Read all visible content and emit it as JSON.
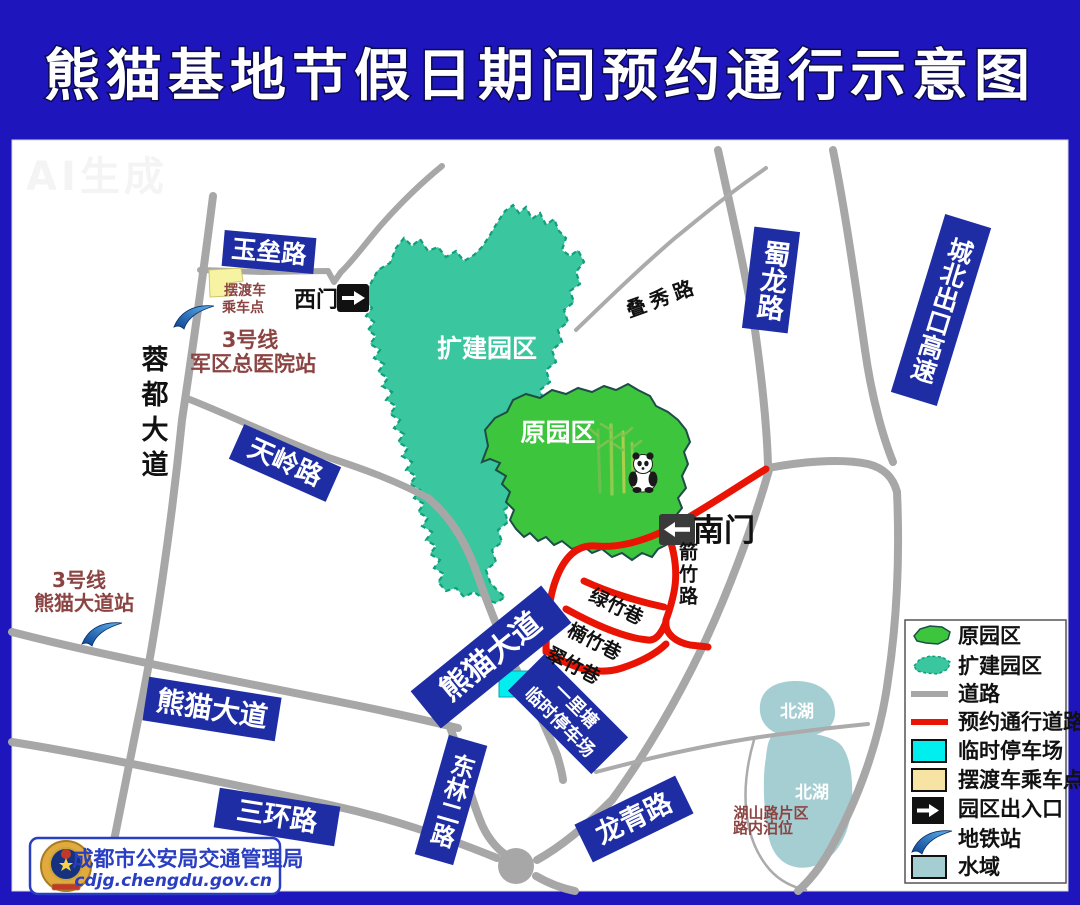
{
  "title": "熊猫基地节假日期间预约通行示意图",
  "watermark": "AI生成",
  "colors": {
    "frame_blue": "#1f15bd",
    "label_blue": "#1e2da4",
    "original_park_green": "#3ec53e",
    "expanded_park_teal": "#3ac69e",
    "reserved_road_red": "#ea1404",
    "road_gray": "#a7a7a7",
    "water_blue": "#a5ced3",
    "temp_parking_cyan": "#00eeee",
    "shuttle_yellow": "#f6f3a2",
    "station_brown": "#8b4442"
  },
  "map": {
    "parks": {
      "expanded_label": "扩建园区",
      "original_label": "原园区"
    },
    "road_labels": {
      "yulei": "玉垒路",
      "rongdu": "蓉都大道",
      "tianling": "天岭路",
      "xiongmao_west": "熊猫大道",
      "xiongmao_diag": "熊猫大道",
      "sanhuan": "三环路",
      "donglin": "东林二路",
      "longqing": "龙青路",
      "shulong": "蜀龙路",
      "chengbei": "城北出口高速",
      "diexiu": "叠秀路",
      "jianzhu": "箭竹路",
      "lvzhu": "绿竹巷",
      "nanzhu": "楠竹巷",
      "cuizhu": "翠竹巷"
    },
    "gates": {
      "west": "西门",
      "south": "南门"
    },
    "metro_stations": {
      "junqu": {
        "line1": "3号线",
        "line2": "军区总医院站"
      },
      "panda_ave": {
        "line1": "3号线",
        "line2": "熊猫大道站"
      }
    },
    "shuttle_point": {
      "line1": "摆渡车",
      "line2": "乘车点"
    },
    "temp_parking": {
      "line1": "一里塘",
      "line2": "临时停车场"
    },
    "lake": {
      "north_label": "北湖",
      "south_label": "北湖"
    },
    "roadside_parking": {
      "line1": "湖山路片区",
      "line2": "路内泊位"
    }
  },
  "legend": {
    "items": [
      {
        "icon": "green-area",
        "label": "原园区"
      },
      {
        "icon": "teal-area",
        "label": "扩建园区"
      },
      {
        "icon": "gray-line",
        "label": "道路"
      },
      {
        "icon": "red-line",
        "label": "预约通行道路"
      },
      {
        "icon": "cyan-square",
        "label": "临时停车场"
      },
      {
        "icon": "yellow-square",
        "label": "摆渡车乘车点"
      },
      {
        "icon": "gate-arrow",
        "label": "园区出入口"
      },
      {
        "icon": "metro-swoosh",
        "label": "地铁站"
      },
      {
        "icon": "water-square",
        "label": "水域"
      }
    ]
  },
  "footer": {
    "agency": "成都市公安局交通管理局",
    "website": "cdjg.chengdu.gov.cn"
  }
}
